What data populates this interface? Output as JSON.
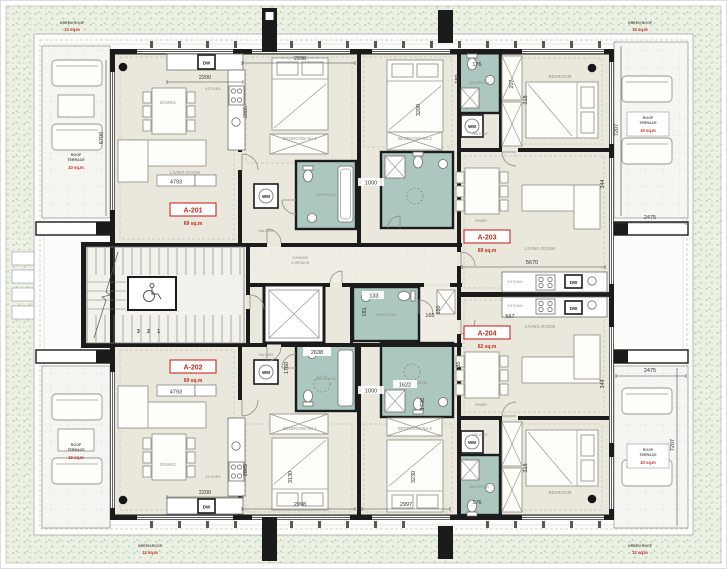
{
  "apartments": {
    "a201": {
      "id": "A-201",
      "area": "69 sq.m"
    },
    "a202": {
      "id": "A-202",
      "area": "69 sq.m"
    },
    "a203": {
      "id": "A-203",
      "area": "69 sq.m"
    },
    "a204": {
      "id": "A-204",
      "area": "62 sq.m"
    }
  },
  "terraces": {
    "corner_tl": {
      "title": "GREEN ROOF",
      "area": "13 sq.m"
    },
    "corner_tr": {
      "title": "GREEN ROOF",
      "area": "13 sq.m"
    },
    "corner_bl": {
      "title": "GREEN ROOF",
      "area": "12 sq.m"
    },
    "corner_br": {
      "title": "GREEN ROOF",
      "area": "12 sq.m"
    },
    "left_upper": {
      "line1": "ROOF",
      "line2": "TERRACE",
      "area": "10 sq.m"
    },
    "left_lower": {
      "line1": "ROOF",
      "line2": "TERRACE",
      "area": "10 sq.m"
    },
    "right_upper": {
      "line1": "ROOF",
      "line2": "TERRACE",
      "area": "10 sq.m"
    },
    "right_lower": {
      "line1": "ROOF",
      "line2": "TERRACE",
      "area": "10 sq.m"
    }
  },
  "rooms": {
    "living": "LIVING ROOM",
    "dining": "DINING",
    "kitchen": "KITCHEN",
    "bedroom1": "BEDROOM No.1",
    "bedroom2": "BEDROOM No.2",
    "bedroom": "BEDROOM",
    "hallway": "HALLWAY",
    "bathroom": "BATHROOM",
    "corridor_line1": "COMMON",
    "corridor_line2": "CORRIDOR"
  },
  "appliances": {
    "dishwasher": "DW",
    "washing_machine": "WM"
  },
  "stairs": {
    "steps": "3 2 1"
  },
  "dims": {
    "d2998t": "2998",
    "d2200t": "2200",
    "d2005t": "2005",
    "d3200": "3200",
    "d4793t": "4793",
    "d6700": "6700",
    "d176t": "176",
    "d180t": "180",
    "d207t": "207",
    "d318t": "318",
    "d344t": "344",
    "d7207t": "7207",
    "d2475t": "2475",
    "d5670": "5670",
    "d1000t": "1000",
    "d133": "133",
    "d181": "181",
    "d165": "165",
    "d150": "150",
    "d535": "535",
    "d1760": "1760",
    "d2638": "2638",
    "d567": "567",
    "d2475b": "2475",
    "d7207b": "7207",
    "d4793b": "4793",
    "d2200b": "2200",
    "d2005b": "2005",
    "d2998b": "2998",
    "d2997b": "2997",
    "d3130": "3130",
    "d3230": "3230",
    "d1000b": "1000",
    "d1622": "1622",
    "d1736": "1736",
    "d176b": "176",
    "d318b": "318",
    "d344b": "344"
  }
}
